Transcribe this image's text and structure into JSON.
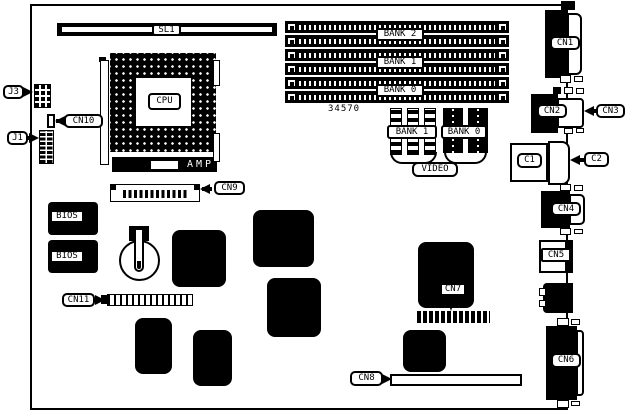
{
  "colors": {
    "ink": "#000000",
    "paper": "#ffffff"
  },
  "board": {
    "part_number": "34570",
    "slot": {
      "label": "SL1"
    },
    "cpu": {
      "label": "CPU"
    },
    "amp": {
      "label": "AMP"
    },
    "memory_banks": [
      {
        "label": "BANK 2"
      },
      {
        "label": "BANK 1"
      },
      {
        "label": "BANK 0"
      }
    ],
    "video_memory": {
      "bank1_label": "BANK 1",
      "bank0_label": "BANK 0",
      "group_label": "VIDEO"
    },
    "bios": {
      "chip1_label": "BIOS",
      "chip2_label": "BIOS"
    },
    "connectors": {
      "j3": "J3",
      "j1": "J1",
      "cn10": "CN10",
      "cn9": "CN9",
      "cn11": "CN11",
      "cn7": "CN7",
      "cn8": "CN8",
      "cn1": "CN1",
      "cn2": "CN2",
      "cn3": "CN3",
      "c1": "C1",
      "c2": "C2",
      "cn4": "CN4",
      "cn5": "CN5",
      "cn6": "CN6"
    }
  }
}
